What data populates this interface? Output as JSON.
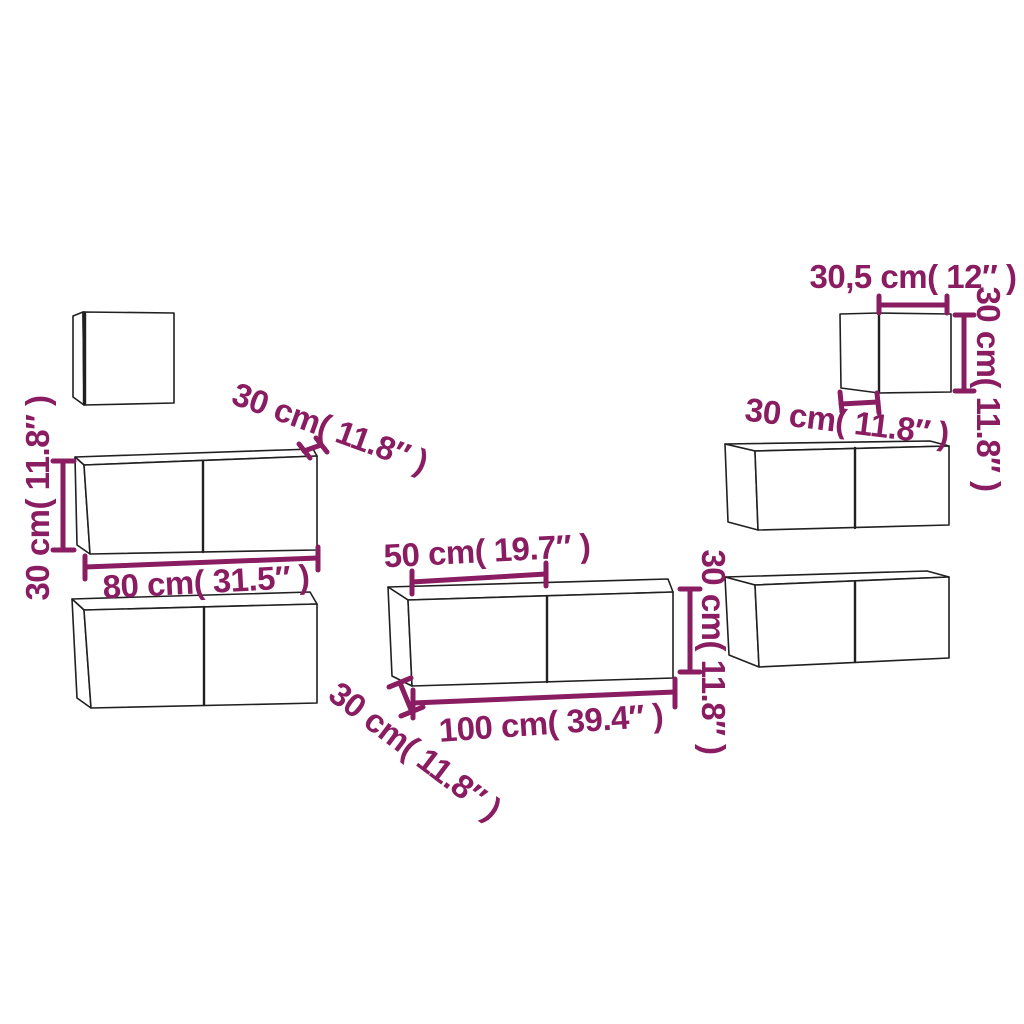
{
  "diagram": {
    "colors": {
      "accent": "#8A1C61",
      "outline": "#202020",
      "background": "#ffffff"
    },
    "labels": {
      "small_width": "30,5 cm( 12″ )",
      "small_height": "30 cm( 11.8″ )",
      "small_depth": "30 cm( 11.8″ )",
      "left_height": "30 cm( 11.8″ )",
      "left_depth": "30 cm( 11.8″ )",
      "left_width": "80 cm( 31.5″ )",
      "center_door_width": "50 cm( 19.7″ )",
      "center_width": "100 cm( 39.4″ )",
      "center_height": "30 cm( 11.8″ )",
      "center_depth": "30 cm( 11.8″ )"
    }
  }
}
